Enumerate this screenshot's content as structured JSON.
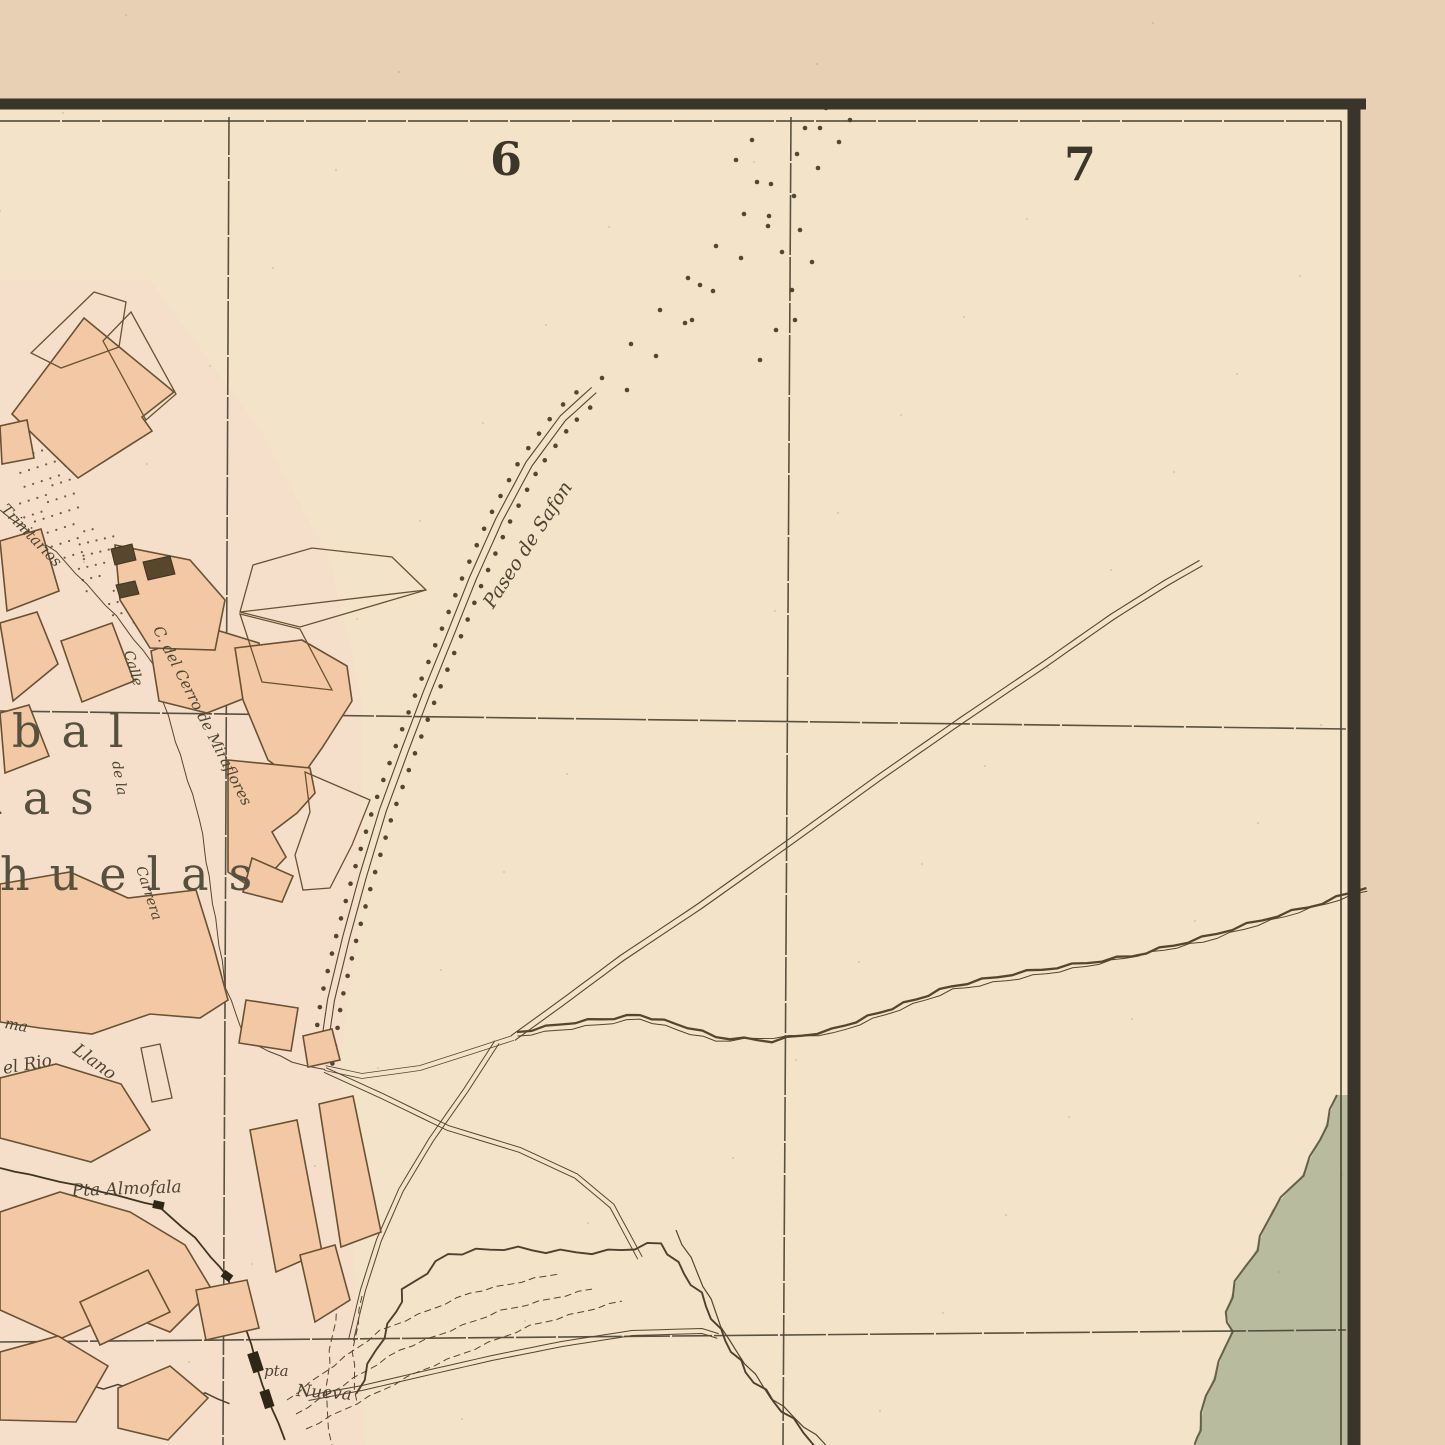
{
  "grid": {
    "sector_left": "6",
    "sector_right": "7"
  },
  "district": {
    "line0": "a",
    "line1": "bal",
    "line2": "las",
    "line3": "huelas"
  },
  "streets": {
    "paseo": "Paseo de Safon",
    "trinitarios": "Trinitarios",
    "cerro": "C. del Cerro de Miraflores",
    "calle": "Calle",
    "dela": "de la",
    "carrera": "Carrera",
    "rio1": "el Rio",
    "rio2": "Llano",
    "frag_ma": "ma"
  },
  "gates": {
    "almofala": "Pta Almofala",
    "nueva_line1": "pta",
    "nueva_line2": "Nueva"
  },
  "colors": {
    "paper_margin": "#e7d0b4",
    "paper_map": "#f3e3c8",
    "city_wash": "#f7dccb",
    "building_fill": "#f2c9a4",
    "building_stroke": "#6a5134",
    "ink": "#4c4433",
    "grid_line": "#4c4636",
    "border": "#3a352a",
    "river_green": "#b9bb9e",
    "green_edge": "#63604a",
    "tree_dot": "#40351f"
  }
}
